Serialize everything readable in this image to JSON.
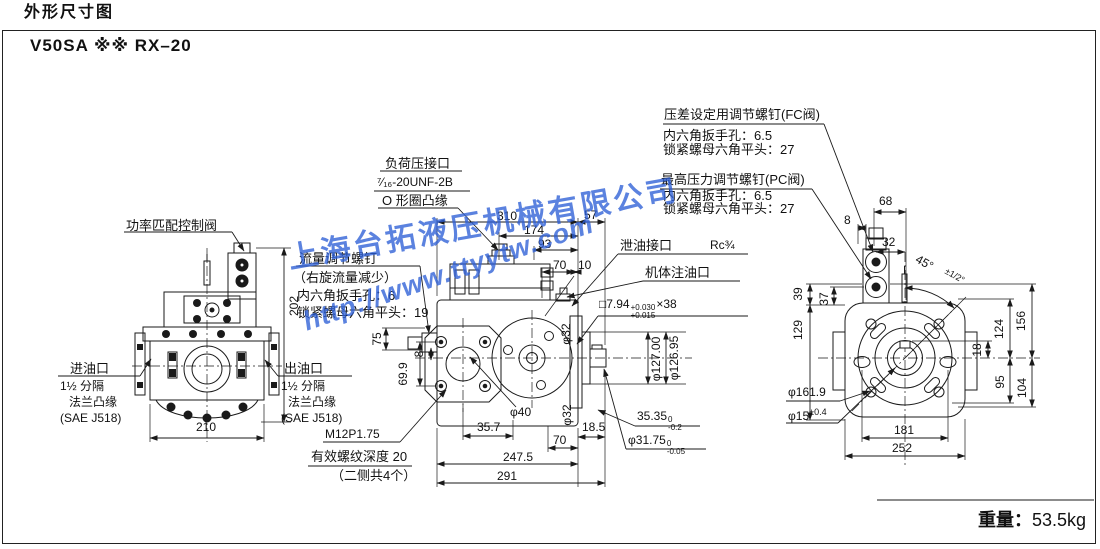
{
  "header": {
    "title": "外形尺寸图",
    "model": "V50SA ※※ RX–20"
  },
  "footer": {
    "weight_label": "重量：",
    "weight_value": "53.5kg"
  },
  "watermark": {
    "company": "上海台拓液压机械有限公司",
    "url": "http://www.ttyytw.com",
    "color": "#2d5fd6"
  },
  "front_view": {
    "power_valve_label": "功率匹配控制阀",
    "inlet": {
      "title": "进油口",
      "line1": "1½ 分隔",
      "line2": "法兰凸缘",
      "line3": "(SAE J518)"
    },
    "outlet": {
      "title": "出油口",
      "line1": "1½ 分隔",
      "line2": "法兰凸缘",
      "line3": "(SAE J518)"
    },
    "dim_height": "202",
    "dim_width": "210"
  },
  "side_view": {
    "load_port": {
      "line1": "负荷压接口",
      "line2": "⁷⁄₁₆-20UNF-2B",
      "line3": "O 形圈凸缘"
    },
    "flow_screw": {
      "line1": "流量调节螺钉",
      "line2": "（右旋流量减少）",
      "line3": "内六角扳手孔：6",
      "line4": "锁紧螺母六角平头：19"
    },
    "drain": {
      "label": "泄油接口",
      "size": "Rc¾"
    },
    "fill_label": "机体注油口",
    "key": {
      "prefix": "□7.94",
      "tol_top": "+0.030",
      "tol_bottom": "+0.015",
      "suffix": "×38"
    },
    "thread_note": {
      "line1": "M12P1.75",
      "line2": "有效螺纹深度 20",
      "line3": "（二侧共4个）"
    },
    "dims": {
      "d310": "310",
      "d57": "57",
      "d174": "174",
      "d93": "93",
      "d70": "70",
      "d10": "10",
      "d75": "75",
      "d69_9": "69.9",
      "d8": "8",
      "phi32": "φ32",
      "phi40": "φ40",
      "d35_7": "35.7",
      "d18_5": "18.5",
      "d70b": "70",
      "d247_5": "247.5",
      "d291": "291",
      "phi127": "φ127.00",
      "phi126": "φ126.95",
      "d35_35": {
        "value": "35.35",
        "tol_top": "0",
        "tol_bottom": "-0.2"
      },
      "phi31_75": {
        "value": "φ31.75",
        "tol_top": "0",
        "tol_bottom": "-0.05"
      }
    }
  },
  "rear_view": {
    "fc_valve": {
      "line1": "压差设定用调节螺钉(FC阀)",
      "line2": "内六角扳手孔：6.5",
      "line3": "锁紧螺母六角平头：27"
    },
    "pc_valve": {
      "line1": "最高压力调节螺钉(PC阀)",
      "line2": "内六角扳手孔：6.5",
      "line3": "锁紧螺母六角平头：27"
    },
    "dims": {
      "d8": "8",
      "d68": "68",
      "d32": "32",
      "angle": "45°",
      "angle_tol": "±1/2°",
      "d39": "39",
      "d37": "37",
      "d129": "129",
      "d124": "124",
      "d156": "156",
      "d18": "18",
      "d95": "95",
      "d104": "104",
      "phi161_9": "φ161.9",
      "phi15": "φ15",
      "phi15_tol": "±0.4",
      "d181": "181",
      "d252": "252"
    }
  }
}
